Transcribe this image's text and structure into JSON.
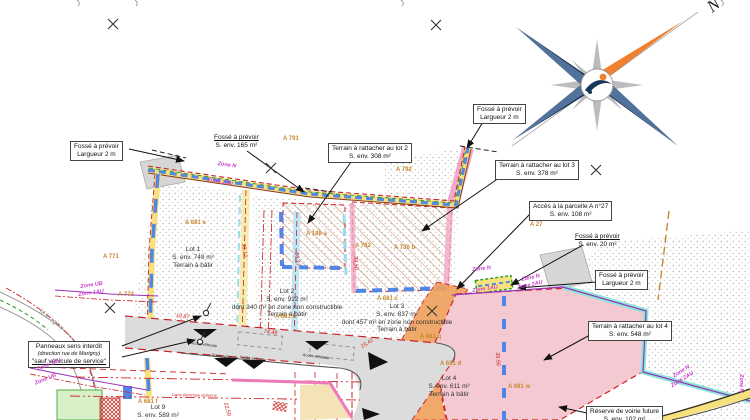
{
  "compass": {
    "north_label": "N"
  },
  "annotations": [
    {
      "lines": [
        "Fossé à prévoir",
        "Largueur 2 m"
      ]
    },
    {
      "lines": [
        "Fossé à prévoir",
        "S. env. 165 m²"
      ]
    },
    {
      "lines": [
        "Terrain à rattacher au lot 2",
        "S. env. 308 m²"
      ]
    },
    {
      "lines": [
        "Fossé à prévoir",
        "Largueur 2 m"
      ]
    },
    {
      "lines": [
        "Terrain à rattacher au lot 3",
        "S. env. 378 m²"
      ]
    },
    {
      "lines": [
        "Accès à la parcelle A n°27",
        "S. env. 108 m²"
      ]
    },
    {
      "lines": [
        "Fossé à prévoir",
        "S. env. 20 m²"
      ]
    },
    {
      "lines": [
        "Fossé à prévoir",
        "Largueur 2 m"
      ]
    },
    {
      "lines": [
        "Terrain à rattacher au lot 4",
        "S. env. 548 m²"
      ]
    },
    {
      "lines": [
        "Réserve de voirie future",
        "S. env. 102 m²"
      ]
    },
    {
      "lines": [
        "Panneaux sens interdit",
        "(direction rue de Marigny)",
        "\"sauf véhicule de service\""
      ]
    }
  ],
  "lots": [
    {
      "lines": [
        "Lot 1",
        "S. env. 749 m²",
        "Terrain à bâtir"
      ]
    },
    {
      "lines": [
        "Lot 2",
        "S. env. 912 m²",
        "dont 340 m² en zone non constructible",
        "Terrain à bâtir"
      ]
    },
    {
      "lines": [
        "Lot 3",
        "S. env. 837 m²",
        "dont 457 m² en zone non constructible",
        "Terrain à bâtir"
      ]
    },
    {
      "lines": [
        "Lot 4",
        "S. env. 611 m²",
        "Terrain à bâtir"
      ]
    },
    {
      "lines": [
        "Lot 9",
        "S. env. 589 m²"
      ]
    }
  ],
  "parcels": [
    "A 791",
    "A 792",
    "A 771",
    "A 772",
    "A 681 e",
    "A 188 a",
    "A 782",
    "A 730 b",
    "A 27",
    "A 681 b",
    "A 681 c",
    "A 681 q",
    "A 681 d",
    "A 681 w",
    "A 681 f"
  ],
  "zones": [
    "Zone N",
    "Zone 1AU",
    "Zone UB",
    "Zone 1AU",
    "Zone 1AU",
    "Zone UB",
    "Zone N",
    "Zone N",
    "Zone 2AU",
    "Zone 1AU",
    "Zone N",
    "Zone 2AU",
    "Zone N"
  ],
  "dimensions": [
    "19,87",
    "74,49",
    "38,12",
    "56,17",
    "39,50",
    "15,41",
    "39,56",
    "22,59"
  ],
  "road": {
    "street_name": "Marigny",
    "access_label": "Accès véhicule",
    "easement_label": "Ligne électrique aérienne"
  },
  "colors": {
    "band_yellow": "#f7e17c",
    "band_blue": "#5588e0",
    "band_pink": "#f2a8c8",
    "turquoise": "#8ce6d8",
    "orange_strip": "#f0a05c",
    "pink_parcel": "#f4c9d2",
    "zone_magenta": "#cc3fcc",
    "dim_red": "#cc2222",
    "parcel_orange": "#c8882d",
    "road_gray": "#dcdcdc"
  }
}
